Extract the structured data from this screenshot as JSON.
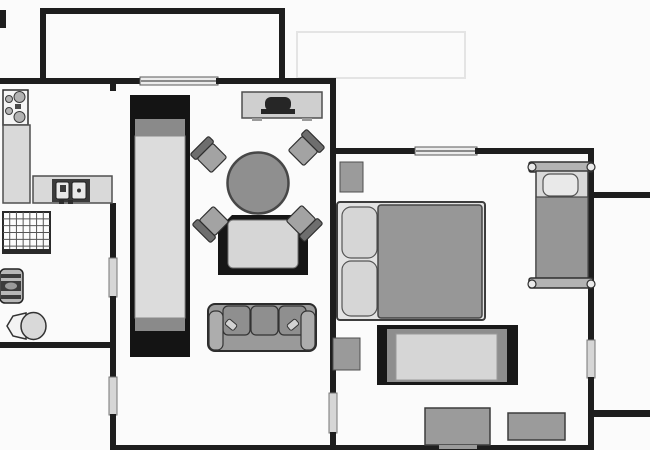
{
  "meta": {
    "kind": "apartment-floor-plan",
    "rooms": [
      "kitchen",
      "bathroom",
      "hallway",
      "living-room",
      "bedroom",
      "balcony-top",
      "balcony-right"
    ],
    "wall_color": "#1e1e1e",
    "background_color": "#fbfbfb",
    "furniture_gray": "#9a9a9a",
    "light_gray": "#d6d6d6",
    "dark_fill": "#161616"
  },
  "canvas": {
    "width": 650,
    "height": 450
  },
  "elements": [
    {
      "name": "cropped-wall-stub",
      "type": "rect",
      "x": 0,
      "y": 10,
      "w": 6,
      "h": 18,
      "fill": "#1e1e1e"
    },
    {
      "name": "balcony-wall-top",
      "type": "rect",
      "x": 40,
      "y": 8,
      "w": 245,
      "h": 6,
      "fill": "#1e1e1e"
    },
    {
      "name": "balcony-wall-left",
      "type": "rect",
      "x": 40,
      "y": 8,
      "w": 6,
      "h": 74,
      "fill": "#1e1e1e"
    },
    {
      "name": "balcony-wall-right",
      "type": "rect",
      "x": 279,
      "y": 8,
      "w": 6,
      "h": 74,
      "fill": "#1e1e1e"
    },
    {
      "name": "faint-outline",
      "type": "rect",
      "x": 297,
      "y": 32,
      "w": 168,
      "h": 46,
      "fill": "none",
      "stroke": "#e4e4e4",
      "sw": 2
    },
    {
      "name": "top-wall-left",
      "type": "rect",
      "x": 0,
      "y": 78,
      "w": 142,
      "h": 6,
      "fill": "#1e1e1e"
    },
    {
      "name": "balcony-window",
      "type": "rect",
      "x": 140,
      "y": 77,
      "w": 78,
      "h": 8,
      "fill": "#ececec",
      "stroke": "#5a5a5a",
      "sw": 1
    },
    {
      "name": "balcony-window-rail",
      "type": "line",
      "x1": 141,
      "y1": 81,
      "x2": 217,
      "y2": 81,
      "stroke": "#6a6a6a",
      "sw": 1.5
    },
    {
      "name": "top-wall-right",
      "type": "rect",
      "x": 216,
      "y": 78,
      "w": 120,
      "h": 6,
      "fill": "#1e1e1e"
    },
    {
      "name": "kitchen-wall-stub",
      "type": "rect",
      "x": 110,
      "y": 84,
      "w": 6,
      "h": 7,
      "fill": "#1e1e1e"
    },
    {
      "name": "left-wall-upper",
      "type": "rect",
      "x": 110,
      "y": 203,
      "w": 6,
      "h": 56,
      "fill": "#1e1e1e"
    },
    {
      "name": "bathroom-door",
      "type": "rect",
      "x": 109,
      "y": 258,
      "w": 8,
      "h": 39,
      "fill": "#d6d6d6",
      "stroke": "#757575",
      "sw": 1
    },
    {
      "name": "left-wall-mid",
      "type": "rect",
      "x": 110,
      "y": 296,
      "w": 6,
      "h": 82,
      "fill": "#1e1e1e"
    },
    {
      "name": "hallway-door",
      "type": "rect",
      "x": 109,
      "y": 377,
      "w": 8,
      "h": 38,
      "fill": "#d6d6d6",
      "stroke": "#757575",
      "sw": 1
    },
    {
      "name": "left-wall-lower",
      "type": "rect",
      "x": 110,
      "y": 414,
      "w": 6,
      "h": 36,
      "fill": "#1e1e1e"
    },
    {
      "name": "bathroom-wall-bottom",
      "type": "rect",
      "x": 0,
      "y": 342,
      "w": 116,
      "h": 6,
      "fill": "#1e1e1e"
    },
    {
      "name": "mid-wall-upper",
      "type": "rect",
      "x": 330,
      "y": 84,
      "w": 6,
      "h": 310,
      "fill": "#1e1e1e"
    },
    {
      "name": "living-bedroom-door",
      "type": "rect",
      "x": 329,
      "y": 393,
      "w": 8,
      "h": 40,
      "fill": "#d6d6d6",
      "stroke": "#757575",
      "sw": 1
    },
    {
      "name": "mid-wall-lower",
      "type": "rect",
      "x": 330,
      "y": 432,
      "w": 6,
      "h": 18,
      "fill": "#1e1e1e"
    },
    {
      "name": "bedroom-wall-top-left",
      "type": "rect",
      "x": 333,
      "y": 148,
      "w": 84,
      "h": 6,
      "fill": "#1e1e1e"
    },
    {
      "name": "bedroom-window",
      "type": "rect",
      "x": 415,
      "y": 147,
      "w": 62,
      "h": 8,
      "fill": "#ececec",
      "stroke": "#5a5a5a",
      "sw": 1
    },
    {
      "name": "bedroom-window-rail",
      "type": "line",
      "x1": 416,
      "y1": 151,
      "x2": 476,
      "y2": 151,
      "stroke": "#6a6a6a",
      "sw": 1.5
    },
    {
      "name": "bedroom-wall-top-right",
      "type": "rect",
      "x": 475,
      "y": 148,
      "w": 119,
      "h": 6,
      "fill": "#1e1e1e"
    },
    {
      "name": "right-wall-upper",
      "type": "rect",
      "x": 588,
      "y": 148,
      "w": 6,
      "h": 193,
      "fill": "#1e1e1e"
    },
    {
      "name": "balcony-right-door",
      "type": "rect",
      "x": 587,
      "y": 340,
      "w": 8,
      "h": 38,
      "fill": "#d6d6d6",
      "stroke": "#757575",
      "sw": 1
    },
    {
      "name": "right-wall-lower",
      "type": "rect",
      "x": 588,
      "y": 377,
      "w": 6,
      "h": 73,
      "fill": "#1e1e1e"
    },
    {
      "name": "bottom-wall",
      "type": "rect",
      "x": 110,
      "y": 445,
      "w": 484,
      "h": 5,
      "fill": "#1e1e1e"
    },
    {
      "name": "balcony-right-wall-top",
      "type": "rect",
      "x": 594,
      "y": 192,
      "w": 56,
      "h": 6,
      "fill": "#1e1e1e"
    },
    {
      "name": "balcony-right-wall-bottom",
      "type": "rect",
      "x": 594,
      "y": 410,
      "w": 56,
      "h": 7,
      "fill": "#1e1e1e"
    },
    {
      "name": "stove",
      "type": "rect",
      "x": 3,
      "y": 90,
      "w": 25,
      "h": 35,
      "fill": "#f5f5f5",
      "stroke": "#2e2e2e",
      "sw": 1.5
    },
    {
      "name": "stove-burner-small-1",
      "type": "circle",
      "cx": 9,
      "cy": 99,
      "r": 3.5,
      "fill": "#b3b3b3",
      "stroke": "#3a3a3a",
      "sw": 1
    },
    {
      "name": "stove-burner-large-1",
      "type": "circle",
      "cx": 19.5,
      "cy": 97,
      "r": 5.5,
      "fill": "#b3b3b3",
      "stroke": "#3a3a3a",
      "sw": 1
    },
    {
      "name": "stove-burner-small-2",
      "type": "circle",
      "cx": 9,
      "cy": 111,
      "r": 3.5,
      "fill": "#b3b3b3",
      "stroke": "#3a3a3a",
      "sw": 1
    },
    {
      "name": "stove-burner-large-2",
      "type": "circle",
      "cx": 19.5,
      "cy": 117,
      "r": 5.5,
      "fill": "#b3b3b3",
      "stroke": "#3a3a3a",
      "sw": 1
    },
    {
      "name": "stove-grill",
      "type": "rect",
      "x": 15,
      "y": 104,
      "w": 6,
      "h": 5,
      "fill": "#4a4a4a"
    },
    {
      "name": "kitchen-counter",
      "type": "rect",
      "x": 3,
      "y": 125,
      "w": 27,
      "h": 78,
      "fill": "#d9d9d9",
      "stroke": "#4f4f4f",
      "sw": 1.5
    },
    {
      "name": "sink-counter",
      "type": "rect",
      "x": 33,
      "y": 176,
      "w": 79,
      "h": 27,
      "fill": "#d9d9d9",
      "stroke": "#4f4f4f",
      "sw": 1.5
    },
    {
      "name": "sink-unit",
      "type": "rect",
      "x": 52,
      "y": 179,
      "w": 38,
      "h": 23,
      "fill": "#3b3b3b"
    },
    {
      "name": "sink-basin-left",
      "type": "rect",
      "x": 56,
      "y": 182,
      "w": 13,
      "h": 17,
      "cr": 2,
      "fill": "#e9e9e9",
      "stroke": "#222222",
      "sw": 1
    },
    {
      "name": "sink-faucet",
      "type": "rect",
      "x": 60,
      "y": 185,
      "w": 6,
      "h": 7,
      "fill": "#3b3b3b"
    },
    {
      "name": "sink-basin-right",
      "type": "rect",
      "x": 72,
      "y": 182,
      "w": 14,
      "h": 17,
      "cr": 2,
      "fill": "#e9e9e9",
      "stroke": "#222222",
      "sw": 1
    },
    {
      "name": "sink-drain",
      "type": "circle",
      "cx": 79,
      "cy": 190.5,
      "r": 2,
      "fill": "#2e2e2e"
    },
    {
      "name": "sink-knob-left",
      "type": "rect",
      "x": 59,
      "y": 200,
      "w": 5,
      "h": 4,
      "fill": "#2e2e2e"
    },
    {
      "name": "sink-knob-right",
      "type": "rect",
      "x": 68,
      "y": 200,
      "w": 5,
      "h": 4,
      "fill": "#2e2e2e"
    },
    {
      "name": "shower-tray",
      "type": "rect",
      "x": 3,
      "y": 212,
      "w": 47,
      "h": 41,
      "fill": "#fcfcfc",
      "stroke": "#2a2a2a",
      "sw": 2
    },
    {
      "name": "shower-grid",
      "type": "grid",
      "x": 3,
      "y": 212,
      "w": 47,
      "h": 41,
      "cols": 7,
      "rows": 6,
      "stroke": "#555555",
      "sw": 1
    },
    {
      "name": "shower-edge",
      "type": "rect",
      "x": 3,
      "y": 249,
      "w": 47,
      "h": 4,
      "fill": "#2a2a2a"
    },
    {
      "name": "washer-body",
      "type": "rect",
      "x": 0,
      "y": 269,
      "w": 23,
      "h": 34,
      "cr": 5,
      "fill": "#b8b8b8",
      "stroke": "#222222",
      "sw": 1.5
    },
    {
      "name": "washer-stripe-1",
      "type": "rect",
      "x": 1,
      "y": 274,
      "w": 20,
      "h": 4,
      "fill": "#3c3c3c"
    },
    {
      "name": "washer-stripe-2",
      "type": "rect",
      "x": 1,
      "y": 281,
      "w": 20,
      "h": 10,
      "fill": "#3c3c3c"
    },
    {
      "name": "washer-drum",
      "type": "ellipse",
      "cx": 11,
      "cy": 286,
      "rx": 6,
      "ry": 3.5,
      "fill": "#9a9a9a"
    },
    {
      "name": "washer-stripe-3",
      "type": "rect",
      "x": 1,
      "y": 295,
      "w": 20,
      "h": 4,
      "fill": "#3c3c3c"
    },
    {
      "name": "toilet-tank",
      "type": "polygon",
      "points": "26,313 26,339 13,336 7,326 13,316",
      "fill": "#f3f3f3",
      "stroke": "#333333",
      "sw": 1.5
    },
    {
      "name": "toilet-bowl",
      "type": "ellipse",
      "cx": 33.5,
      "cy": 326,
      "rx": 12.5,
      "ry": 13.5,
      "fill": "#d9d9d9",
      "stroke": "#333333",
      "sw": 1.5
    },
    {
      "name": "wardrobe-frame",
      "type": "rect",
      "x": 130,
      "y": 95,
      "w": 60,
      "h": 262,
      "fill": "#141414"
    },
    {
      "name": "wardrobe-shelf-top",
      "type": "rect",
      "x": 135,
      "y": 119,
      "w": 50,
      "h": 17,
      "fill": "#8a8a8a"
    },
    {
      "name": "wardrobe-body",
      "type": "rect",
      "x": 135,
      "y": 136,
      "w": 50,
      "h": 182,
      "fill": "#dcdcdc",
      "stroke": "#8a8a8a",
      "sw": 1
    },
    {
      "name": "wardrobe-shelf-bottom",
      "type": "rect",
      "x": 135,
      "y": 318,
      "w": 50,
      "h": 13,
      "fill": "#8a8a8a"
    },
    {
      "name": "tv-cabinet",
      "type": "rect",
      "x": 242,
      "y": 92,
      "w": 80,
      "h": 26,
      "fill": "#cfcfcf",
      "stroke": "#4f4f4f",
      "sw": 1.5
    },
    {
      "name": "tv-screen",
      "type": "rect",
      "x": 265,
      "y": 97,
      "w": 26,
      "h": 14,
      "cr": 6,
      "fill": "#262626"
    },
    {
      "name": "tv-base",
      "type": "rect",
      "x": 261,
      "y": 109,
      "w": 34,
      "h": 5,
      "fill": "#262626"
    },
    {
      "name": "cabinet-foot-left",
      "type": "rect",
      "x": 252,
      "y": 118,
      "w": 10,
      "h": 3,
      "fill": "#9a9a9a"
    },
    {
      "name": "cabinet-foot-right",
      "type": "rect",
      "x": 302,
      "y": 118,
      "w": 10,
      "h": 3,
      "fill": "#9a9a9a"
    },
    {
      "name": "armchair-frame",
      "type": "polygon",
      "points": "218,229 232,215 294,215 308,229 308,275 218,275",
      "fill": "#161616"
    },
    {
      "name": "armchair-cushion",
      "type": "rect",
      "x": 228,
      "y": 220,
      "w": 70,
      "h": 48,
      "cr": 5,
      "fill": "#d6d6d6",
      "stroke": "#6f6f6f",
      "sw": 1
    },
    {
      "name": "chair-nw-seat",
      "type": "rect",
      "x": 201,
      "y": 148,
      "w": 22,
      "h": 20,
      "cr": 2,
      "fill": "#a3a3a3",
      "stroke": "#2f2f2f",
      "sw": 1.2,
      "transform": "rotate(-45 212 158)"
    },
    {
      "name": "chair-nw-back",
      "type": "rect",
      "x": 199,
      "y": 140,
      "w": 26,
      "h": 8,
      "cr": 2,
      "fill": "#6e6e6e",
      "stroke": "#2f2f2f",
      "sw": 1.2,
      "transform": "rotate(-45 212 158)"
    },
    {
      "name": "chair-ne-seat",
      "type": "rect",
      "x": 292,
      "y": 141,
      "w": 22,
      "h": 20,
      "cr": 2,
      "fill": "#a3a3a3",
      "stroke": "#2f2f2f",
      "sw": 1.2,
      "transform": "rotate(45 303 151)"
    },
    {
      "name": "chair-ne-back",
      "type": "rect",
      "x": 290,
      "y": 133,
      "w": 26,
      "h": 8,
      "cr": 2,
      "fill": "#6e6e6e",
      "stroke": "#2f2f2f",
      "sw": 1.2,
      "transform": "rotate(45 303 151)"
    },
    {
      "name": "chair-sw-seat",
      "type": "rect",
      "x": 203,
      "y": 211,
      "w": 22,
      "h": 20,
      "cr": 2,
      "fill": "#a3a3a3",
      "stroke": "#2f2f2f",
      "sw": 1.2,
      "transform": "rotate(-135 214 221)"
    },
    {
      "name": "chair-sw-back",
      "type": "rect",
      "x": 201,
      "y": 203,
      "w": 26,
      "h": 8,
      "cr": 2,
      "fill": "#6e6e6e",
      "stroke": "#2f2f2f",
      "sw": 1.2,
      "transform": "rotate(-135 214 221)"
    },
    {
      "name": "chair-se-seat",
      "type": "rect",
      "x": 290,
      "y": 210,
      "w": 22,
      "h": 20,
      "cr": 2,
      "fill": "#a3a3a3",
      "stroke": "#2f2f2f",
      "sw": 1.2,
      "transform": "rotate(135 301 220)"
    },
    {
      "name": "chair-se-back",
      "type": "rect",
      "x": 288,
      "y": 202,
      "w": 26,
      "h": 8,
      "cr": 2,
      "fill": "#6e6e6e",
      "stroke": "#2f2f2f",
      "sw": 1.2,
      "transform": "rotate(135 301 220)"
    },
    {
      "name": "dining-table",
      "type": "circle",
      "cx": 258,
      "cy": 183,
      "r": 30.5,
      "fill": "#8f8f8f",
      "stroke": "#474747",
      "sw": 2.5
    },
    {
      "name": "sofa-base",
      "type": "rect",
      "x": 208,
      "y": 304,
      "w": 108,
      "h": 47,
      "cr": 7,
      "fill": "#9a9a9a",
      "stroke": "#2c2c2c",
      "sw": 2
    },
    {
      "name": "sofa-cushion-1",
      "type": "rect",
      "x": 223,
      "y": 306,
      "w": 27,
      "h": 29,
      "cr": 5,
      "fill": "#8f8f8f",
      "stroke": "#333333",
      "sw": 1.2
    },
    {
      "name": "sofa-cushion-2",
      "type": "rect",
      "x": 251,
      "y": 306,
      "w": 27,
      "h": 29,
      "cr": 5,
      "fill": "#8f8f8f",
      "stroke": "#333333",
      "sw": 1.2
    },
    {
      "name": "sofa-cushion-3",
      "type": "rect",
      "x": 279,
      "y": 306,
      "w": 27,
      "h": 29,
      "cr": 5,
      "fill": "#8f8f8f",
      "stroke": "#333333",
      "sw": 1.2
    },
    {
      "name": "sofa-arm-left",
      "type": "rect",
      "x": 209,
      "y": 311,
      "w": 14,
      "h": 39,
      "cr": 6,
      "fill": "#adadad",
      "stroke": "#333333",
      "sw": 1.2
    },
    {
      "name": "sofa-arm-right",
      "type": "rect",
      "x": 301,
      "y": 311,
      "w": 14,
      "h": 39,
      "cr": 6,
      "fill": "#adadad",
      "stroke": "#333333",
      "sw": 1.2
    },
    {
      "name": "sofa-pillow-left",
      "type": "rect",
      "x": 226,
      "y": 321,
      "w": 11,
      "h": 7,
      "cr": 2,
      "fill": "#d2d2d2",
      "stroke": "#333333",
      "sw": 1,
      "transform": "rotate(40 231 324)"
    },
    {
      "name": "sofa-pillow-right",
      "type": "rect",
      "x": 287,
      "y": 321,
      "w": 11,
      "h": 7,
      "cr": 2,
      "fill": "#d2d2d2",
      "stroke": "#333333",
      "sw": 1,
      "transform": "rotate(-40 293 324)"
    },
    {
      "name": "nightstand",
      "type": "rect",
      "x": 340,
      "y": 162,
      "w": 23,
      "h": 30,
      "fill": "#9b9b9b",
      "stroke": "#4f4f4f",
      "sw": 1
    },
    {
      "name": "double-bed-frame",
      "type": "rect",
      "x": 337,
      "y": 202,
      "w": 148,
      "h": 118,
      "cr": 3,
      "fill": "#e3e3e3",
      "stroke": "#3d3d3d",
      "sw": 2
    },
    {
      "name": "double-bed-pillow-top",
      "type": "rect",
      "x": 342,
      "y": 207,
      "w": 35,
      "h": 51,
      "cr": 9,
      "fill": "#d6d6d6",
      "stroke": "#555555",
      "sw": 1.2
    },
    {
      "name": "double-bed-pillow-bottom",
      "type": "rect",
      "x": 342,
      "y": 261,
      "w": 35,
      "h": 55,
      "cr": 9,
      "fill": "#d6d6d6",
      "stroke": "#555555",
      "sw": 1.2
    },
    {
      "name": "double-bed-duvet",
      "type": "rect",
      "x": 378,
      "y": 205,
      "w": 104,
      "h": 113,
      "cr": 3,
      "fill": "#979797",
      "stroke": "#454545",
      "sw": 1.5
    },
    {
      "name": "bench-frame",
      "type": "rect",
      "x": 377,
      "y": 325,
      "w": 141,
      "h": 60,
      "fill": "#181818"
    },
    {
      "name": "bench-mid",
      "type": "rect",
      "x": 387,
      "y": 329,
      "w": 120,
      "h": 53,
      "fill": "#8e8e8e"
    },
    {
      "name": "bench-top",
      "type": "rect",
      "x": 396,
      "y": 334,
      "w": 101,
      "h": 46,
      "fill": "#d6d6d6",
      "stroke": "#999999",
      "sw": 1
    },
    {
      "name": "wall-chest",
      "type": "rect",
      "x": 333,
      "y": 338,
      "w": 27,
      "h": 32,
      "fill": "#9a9a9a",
      "stroke": "#4f4f4f",
      "sw": 1
    },
    {
      "name": "single-bed-headboard",
      "type": "rect",
      "x": 529,
      "y": 162,
      "w": 64,
      "h": 10,
      "cr": 2,
      "fill": "#b3b3b3",
      "stroke": "#2f2f2f",
      "sw": 1.5
    },
    {
      "name": "single-bed-body",
      "type": "rect",
      "x": 536,
      "y": 171,
      "w": 52,
      "h": 108,
      "fill": "#d9d9d9",
      "stroke": "#3d3d3d",
      "sw": 1.5
    },
    {
      "name": "single-bed-pillow",
      "type": "rect",
      "x": 543,
      "y": 174,
      "w": 35,
      "h": 22,
      "cr": 7,
      "fill": "#e9e9e9",
      "stroke": "#555555",
      "sw": 1.2
    },
    {
      "name": "single-bed-duvet",
      "type": "rect",
      "x": 536,
      "y": 197,
      "w": 52,
      "h": 82,
      "fill": "#969696",
      "stroke": "#454545",
      "sw": 1.2
    },
    {
      "name": "single-bed-footboard",
      "type": "rect",
      "x": 529,
      "y": 278,
      "w": 64,
      "h": 10,
      "cr": 2,
      "fill": "#b3b3b3",
      "stroke": "#2f2f2f",
      "sw": 1.5
    },
    {
      "name": "bedknob-top-left",
      "type": "circle",
      "cx": 532,
      "cy": 167,
      "r": 4,
      "fill": "#eaeaea",
      "stroke": "#2f2f2f",
      "sw": 1.2
    },
    {
      "name": "bedknob-top-right",
      "type": "circle",
      "cx": 591,
      "cy": 167,
      "r": 4,
      "fill": "#eaeaea",
      "stroke": "#2f2f2f",
      "sw": 1.2
    },
    {
      "name": "bedknob-bottom-left",
      "type": "circle",
      "cx": 532,
      "cy": 284,
      "r": 4,
      "fill": "#eaeaea",
      "stroke": "#2f2f2f",
      "sw": 1.2
    },
    {
      "name": "bedknob-bottom-right",
      "type": "circle",
      "cx": 591,
      "cy": 284,
      "r": 4,
      "fill": "#eaeaea",
      "stroke": "#2f2f2f",
      "sw": 1.2
    },
    {
      "name": "dresser-left",
      "type": "rect",
      "x": 425,
      "y": 408,
      "w": 65,
      "h": 37,
      "fill": "#9b9b9b",
      "stroke": "#3d3d3d",
      "sw": 1.5
    },
    {
      "name": "dresser-left-foot",
      "type": "rect",
      "x": 439,
      "y": 445,
      "w": 38,
      "h": 4,
      "fill": "#9b9b9b"
    },
    {
      "name": "dresser-right",
      "type": "rect",
      "x": 508,
      "y": 413,
      "w": 57,
      "h": 27,
      "fill": "#9b9b9b",
      "stroke": "#3d3d3d",
      "sw": 1.5
    }
  ]
}
